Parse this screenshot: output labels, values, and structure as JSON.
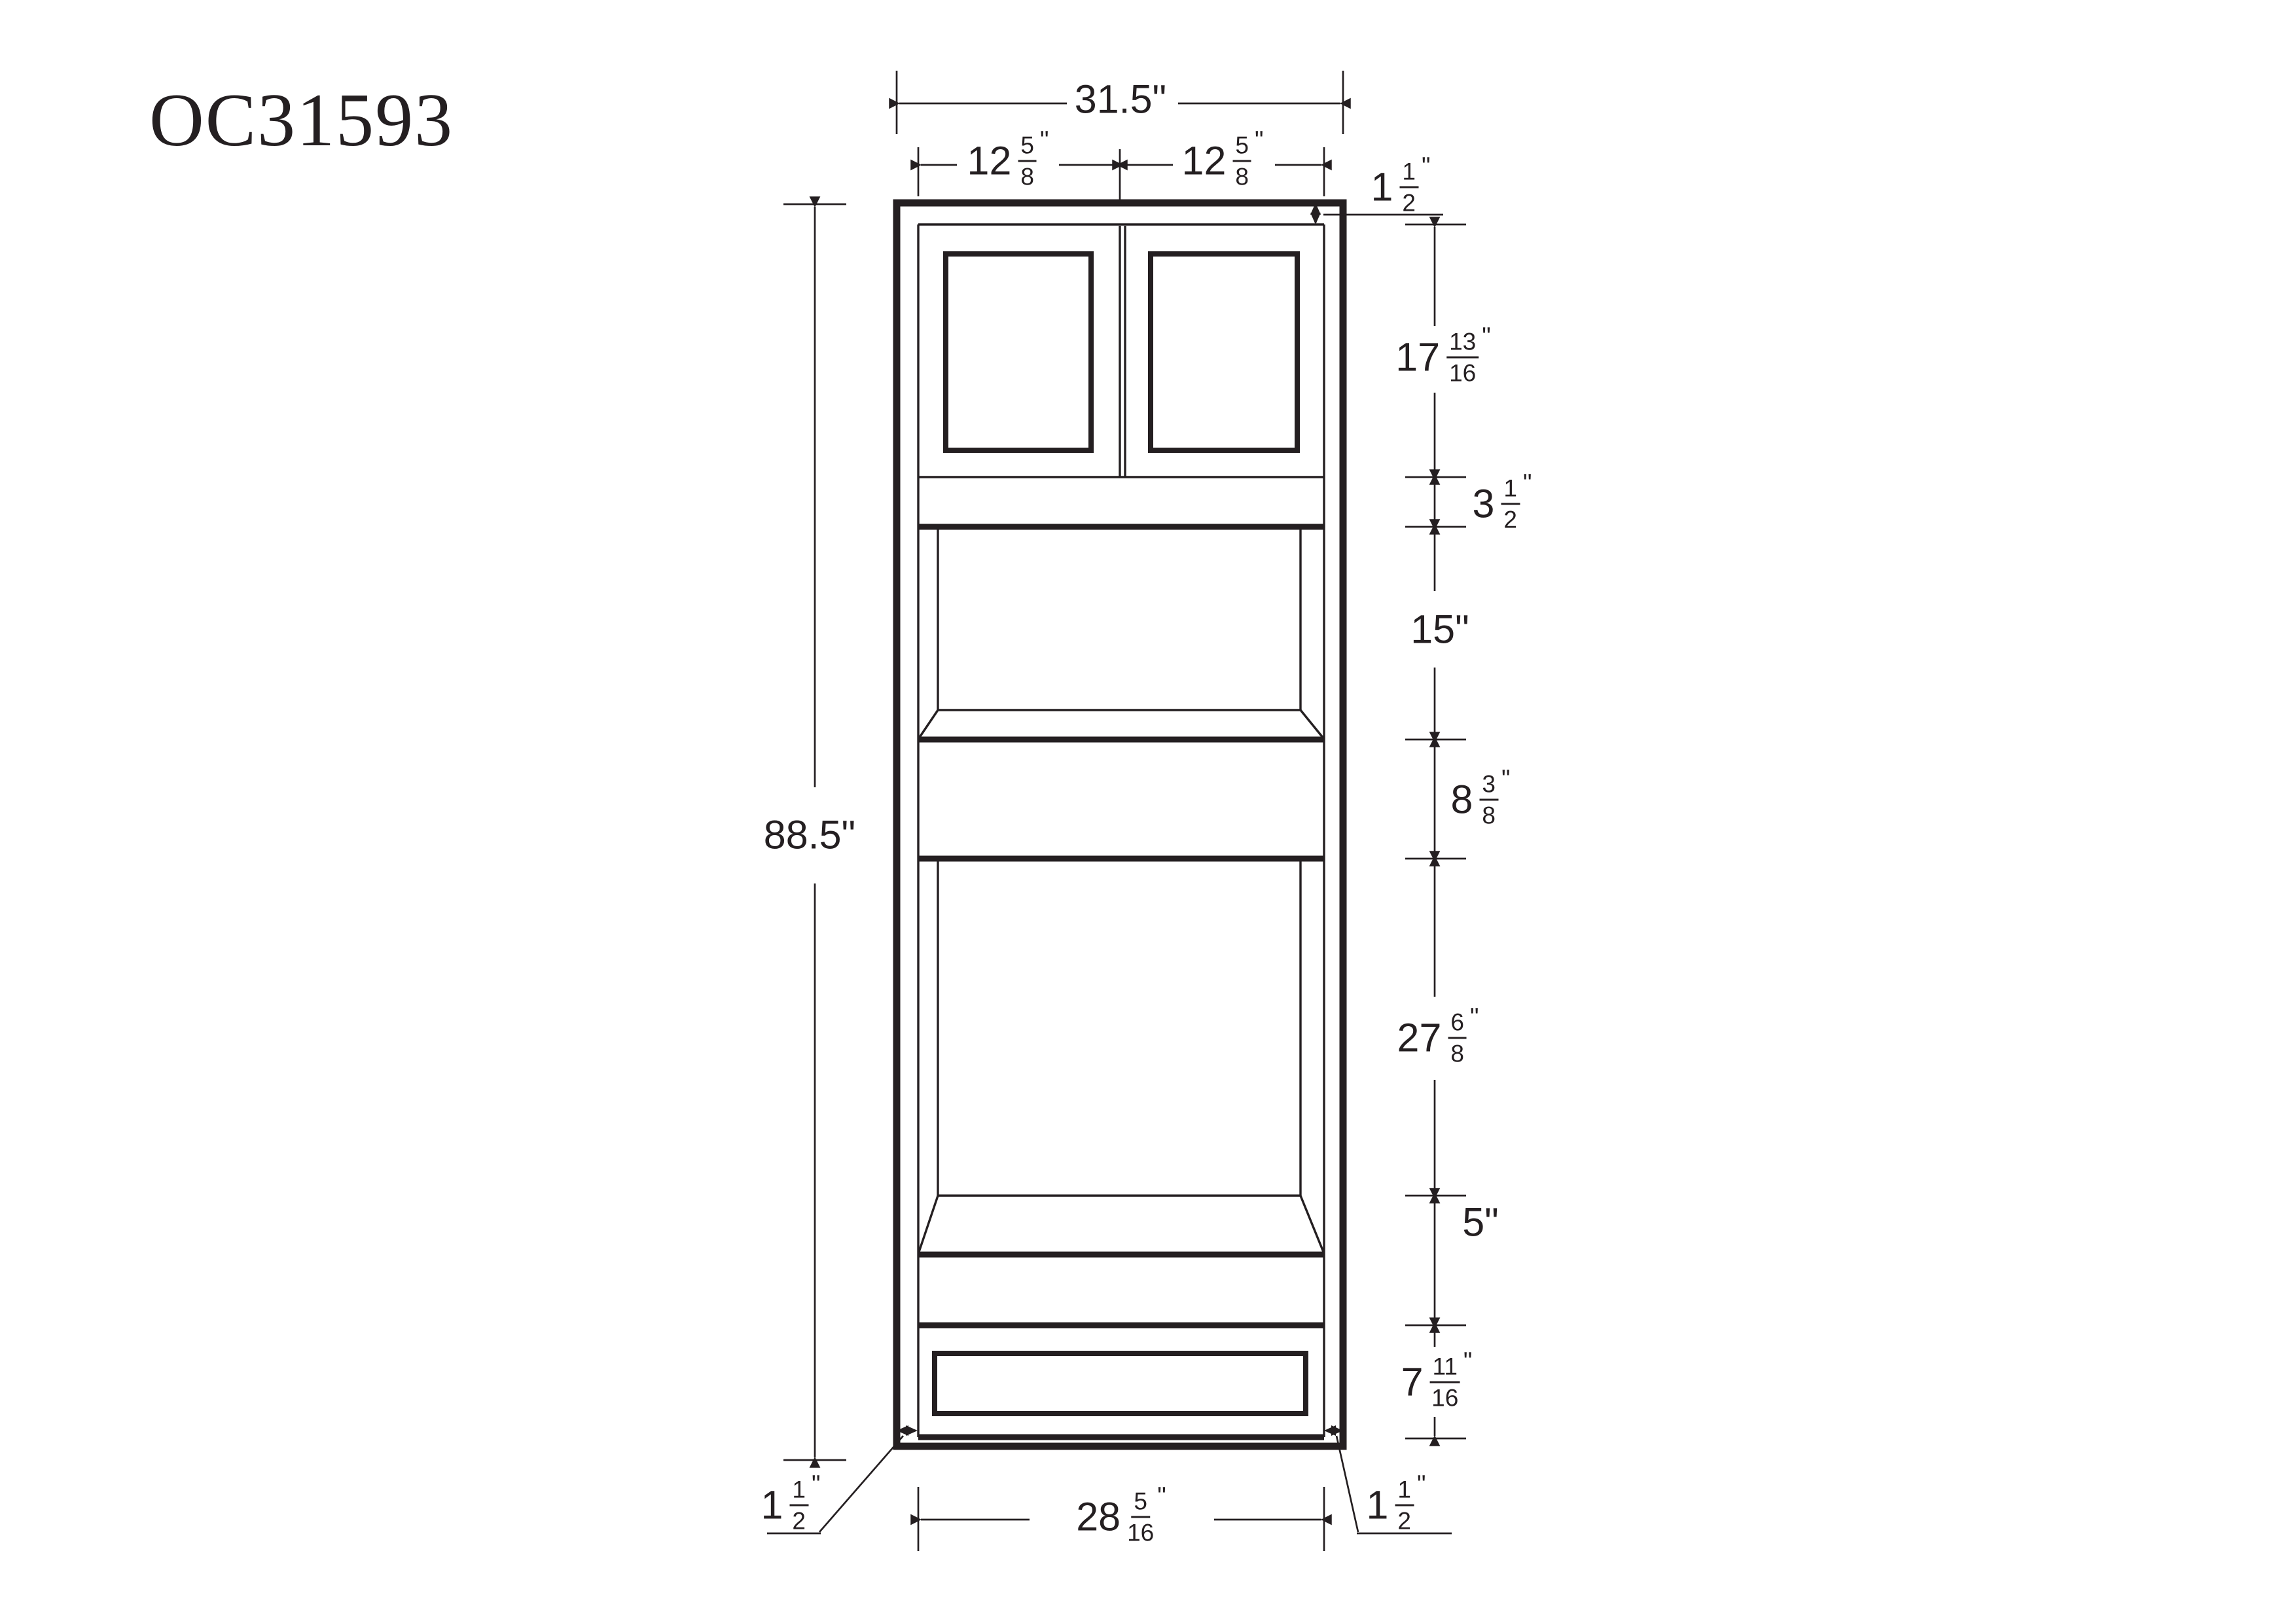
{
  "title": "OC31593",
  "colors": {
    "ink": "#241f21",
    "background": "#ffffff"
  },
  "drawing": {
    "top": {
      "overall_width": {
        "text": "31.5\""
      },
      "left_door_width": {
        "whole": "12",
        "num": "5",
        "den": "8",
        "unit": "\""
      },
      "right_door_width": {
        "whole": "12",
        "num": "5",
        "den": "8",
        "unit": "\""
      }
    },
    "right": {
      "top_rail": {
        "whole": "1",
        "num": "1",
        "den": "2",
        "unit": "\""
      },
      "door_section": {
        "whole": "17",
        "num": "13",
        "den": "16",
        "unit": "\""
      },
      "mid_rail": {
        "whole": "3",
        "num": "1",
        "den": "2",
        "unit": "\""
      },
      "microwave_opening": {
        "text": "15\""
      },
      "middle_drawer": {
        "whole": "8",
        "num": "3",
        "den": "8",
        "unit": "\""
      },
      "oven_opening": {
        "whole": "27",
        "num": "6",
        "den": "8",
        "unit": "\""
      },
      "lower_band": {
        "text": "5\""
      },
      "bottom_drawer": {
        "whole": "7",
        "num": "11",
        "den": "16",
        "unit": "\""
      }
    },
    "left": {
      "overall_height": {
        "text": "88.5\""
      }
    },
    "bottom": {
      "left_stile": {
        "whole": "1",
        "num": "1",
        "den": "2",
        "unit": "\""
      },
      "opening_width": {
        "whole": "28",
        "num": "5",
        "den": "16",
        "unit": "\""
      },
      "right_stile": {
        "whole": "1",
        "num": "1",
        "den": "2",
        "unit": "\""
      }
    }
  }
}
